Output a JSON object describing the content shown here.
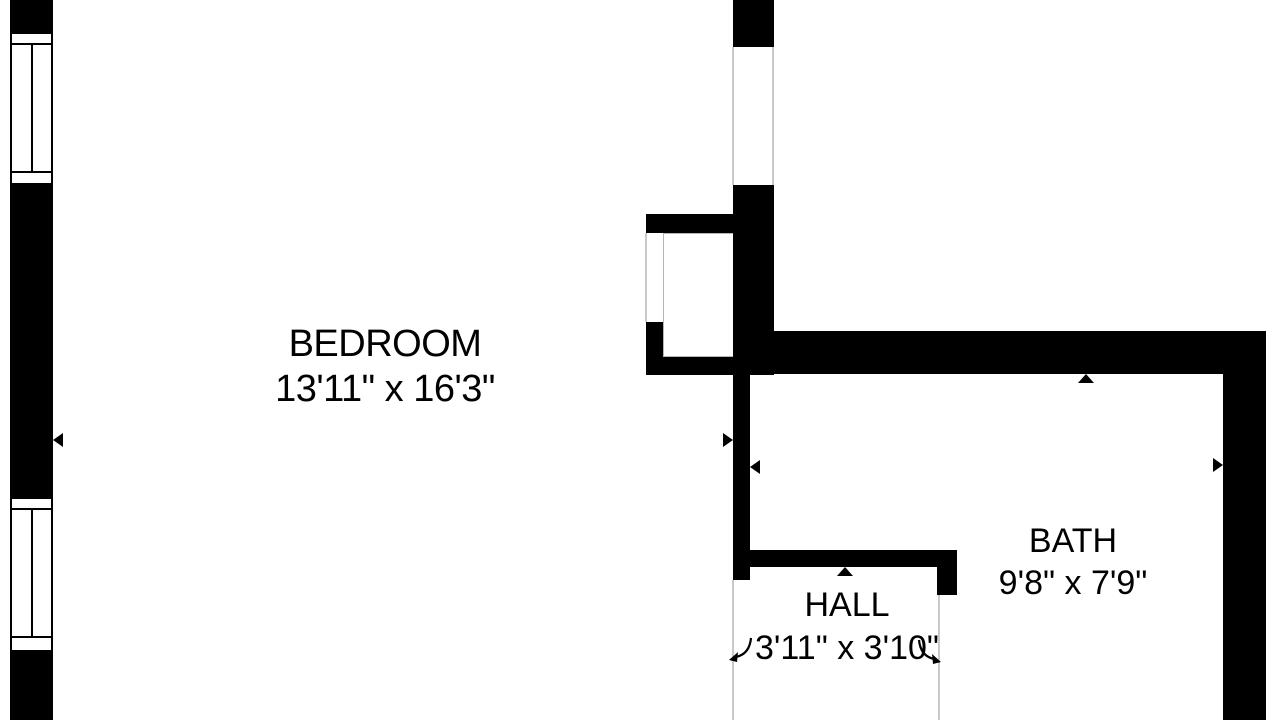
{
  "title": "Apartment floor plan (partial view)",
  "colors": {
    "wall": "#000000",
    "background": "#ffffff",
    "opening_line": "#c9c9c9",
    "label_text": "#000000"
  },
  "rooms": {
    "bedroom": {
      "label": "BEDROOM",
      "dimensions": "13'11\" x 16'3\""
    },
    "bath": {
      "label": "BATH",
      "dimensions": "9'8\" x 7'9\""
    },
    "hall": {
      "label": "HALL",
      "dimensions": "3'11\" x 3'10\""
    }
  },
  "markers": {
    "left_wall_arrow": "triangle-left",
    "bedroom_wall_arrow": "triangle-right",
    "corridor_wall_arrow": "triangle-left",
    "bath_top_arrow": "triangle-up",
    "bath_right_arrow": "triangle-right",
    "hall_top_arrow": "triangle-up",
    "hall_door_left_arrow": "curved-arrow-down-left",
    "hall_door_right_arrow": "curved-arrow-down-right"
  },
  "features": {
    "windows_on_left_wall": 2,
    "door_openings": 3
  }
}
